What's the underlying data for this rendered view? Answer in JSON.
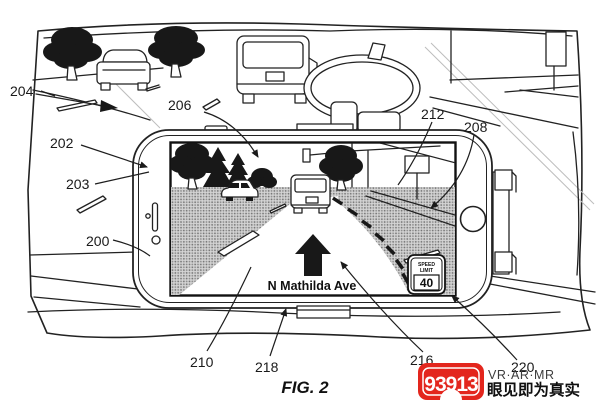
{
  "figure": {
    "caption": "FIG. 2",
    "reference_labels": {
      "l200": "200",
      "l202": "202",
      "l203": "203",
      "l204": "204",
      "l206": "206",
      "l208": "208",
      "l210": "210",
      "l212": "212",
      "l216": "216",
      "l218": "218",
      "l220": "220"
    }
  },
  "phone_screen": {
    "street_name": "N Mathilda Ave",
    "speed_limit_sign": {
      "line1": "SPEED",
      "line2": "LIMIT",
      "value": "40"
    },
    "nav_arrow_icon": "up-arrow"
  },
  "watermark": {
    "logo_text": "93913",
    "tagline": "VR·AR·MR",
    "slogan": "眼见即为真实",
    "brand_color": "#e3261d"
  },
  "colors": {
    "ink": "#222222",
    "shading": "#cfcfcf",
    "background": "#ffffff"
  }
}
